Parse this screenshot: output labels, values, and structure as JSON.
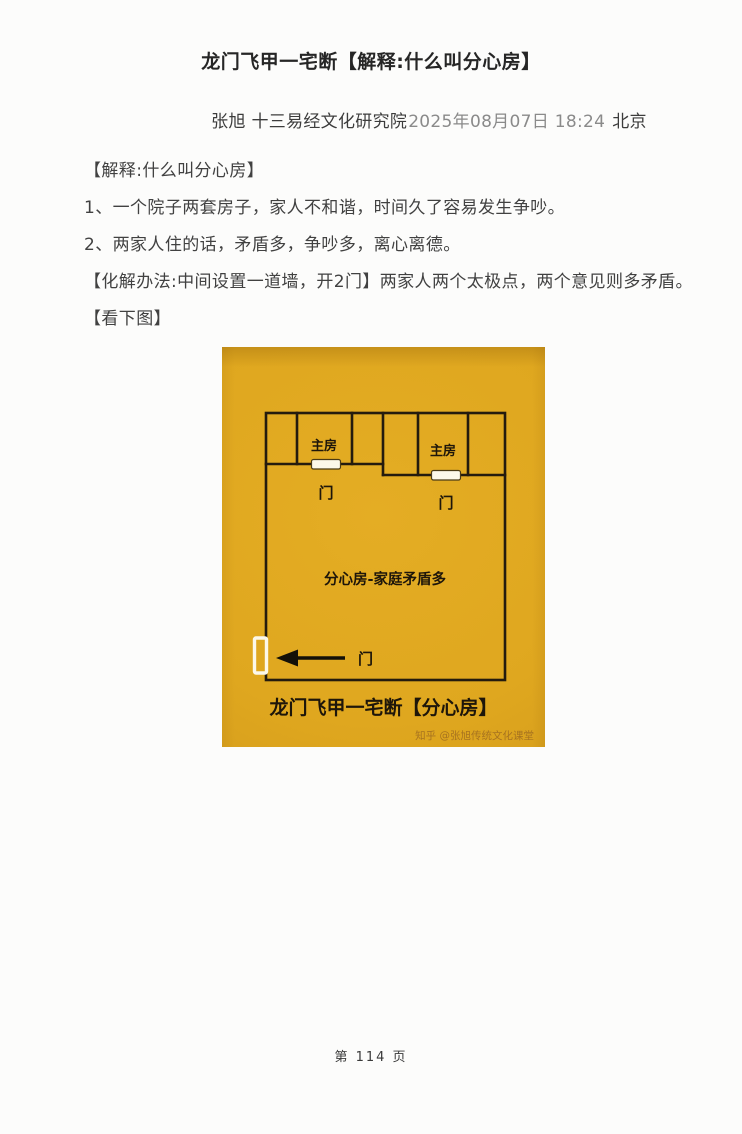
{
  "page": {
    "title": "龙门飞甲一宅断【解释:什么叫分心房】",
    "byline": {
      "author_org": "张旭 十三易经文化研究院",
      "datetime": "2025年08月07日 18:24",
      "location": "北京"
    },
    "body_lines": [
      "【解释:什么叫分心房】",
      "1、一个院子两套房子，家人不和谐，时间久了容易发生争吵。",
      "2、两家人住的话，矛盾多，争吵多，离心离德。",
      "【化解办法:中间设置一道墙，开2门】两家人两个太极点，两个意见则多矛盾。",
      "【看下图】"
    ],
    "footer": "第 114 页"
  },
  "diagram": {
    "room_left_label": "主房",
    "room_right_label": "主房",
    "door_left_label": "门",
    "door_right_label": "门",
    "entrance_door_label": "门",
    "interior_label": "分心房-家庭矛盾多",
    "caption": "龙门飞甲一宅断【分心房】",
    "watermark": "知乎 @张旭传统文化课堂",
    "colors": {
      "card_bg": "#dfa71f",
      "wall_line": "#241b0e",
      "door_fill": "#fcf8ea",
      "door_outline": "#4a3a15",
      "arrow": "#131008",
      "watermark_text": "#9e6b20"
    }
  }
}
